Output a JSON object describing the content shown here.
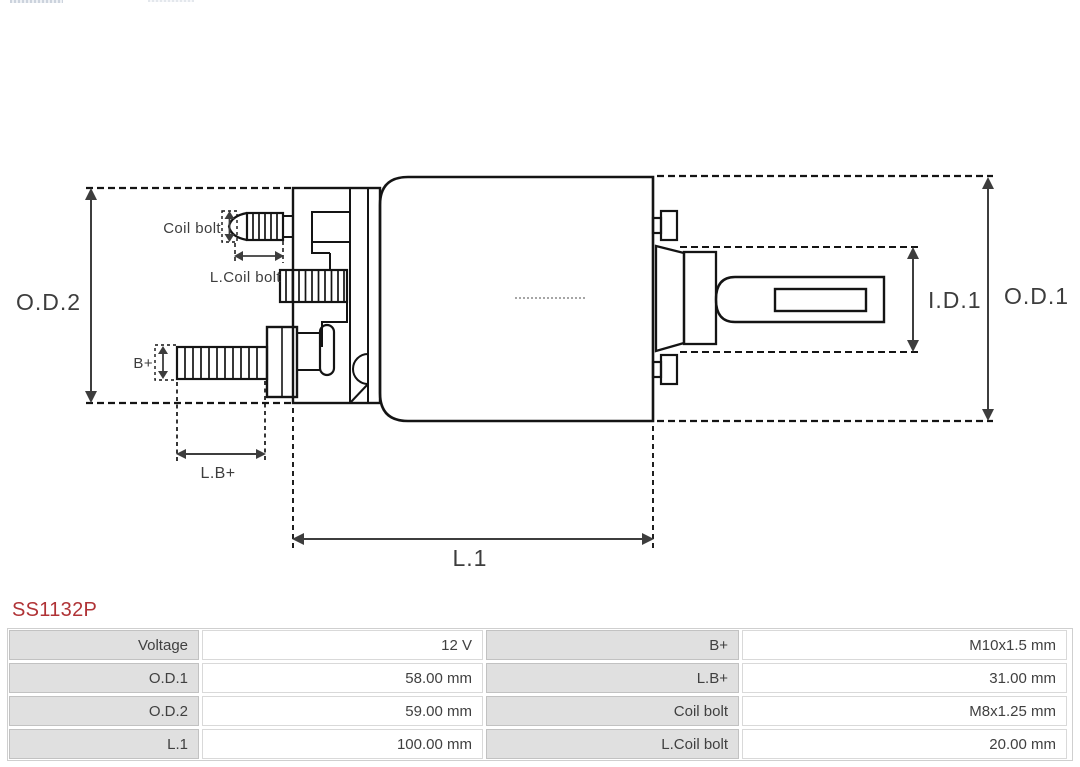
{
  "page": {
    "part_number": "SS1132P"
  },
  "colors": {
    "part_number": "#b03336",
    "drawing_line": "#141414",
    "dimension": "#3d3d3d",
    "table_label_bg": "#e0e0e0"
  },
  "diagram": {
    "labels": {
      "od2": "O.D.2",
      "od1": "O.D.1",
      "id1": "I.D.1",
      "l1": "L.1",
      "lb_plus": "L.B+",
      "b_plus": "B+",
      "coil_bolt": "Coil bolt",
      "l_coil_bolt": "L.Coil bolt"
    }
  },
  "table": {
    "rows": [
      {
        "label1": "Voltage",
        "value1": "12 V",
        "label2": "B+",
        "value2": "M10x1.5 mm"
      },
      {
        "label1": "O.D.1",
        "value1": "58.00 mm",
        "label2": "L.B+",
        "value2": "31.00 mm"
      },
      {
        "label1": "O.D.2",
        "value1": "59.00 mm",
        "label2": "Coil bolt",
        "value2": "M8x1.25 mm"
      },
      {
        "label1": "L.1",
        "value1": "100.00 mm",
        "label2": "L.Coil bolt",
        "value2": "20.00 mm"
      }
    ]
  }
}
